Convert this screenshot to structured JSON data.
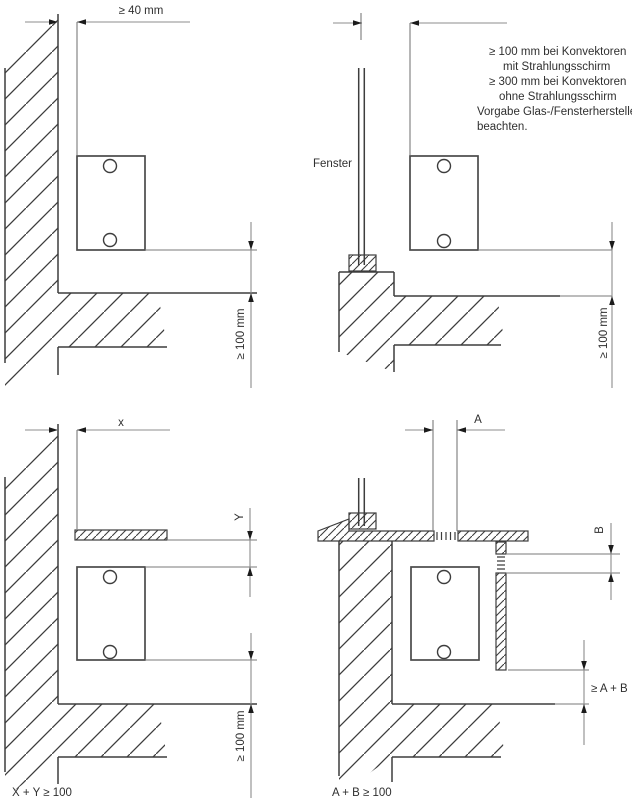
{
  "diagram": {
    "panels": {
      "top_left": {
        "dim_wall_gap": "≥ 40 mm",
        "dim_floor_clearance": "≥ 100 mm"
      },
      "top_right": {
        "window_label": "Fenster",
        "note_lines": [
          "≥ 100 mm bei Konvektoren",
          "mit Strahlungsschirm",
          "≥ 300 mm bei Konvektoren",
          "ohne Strahlungsschirm",
          "Vorgabe Glas-/Fensterhersteller",
          "beachten."
        ],
        "dim_floor_clearance": "≥ 100 mm"
      },
      "bottom_left": {
        "dim_wall_gap": "x",
        "dim_shelf_gap": "Y",
        "dim_floor_clearance": "≥ 100 mm",
        "formula": "X + Y ≥ 100"
      },
      "bottom_right": {
        "dim_grille_width": "A",
        "dim_grille_height": "B",
        "dim_floor_clearance": "≥ A + B",
        "formula": "A + B ≥ 100"
      }
    },
    "colors": {
      "background": "#ffffff",
      "drawing_line": "#3d3d3d",
      "dimension_line": "#8c8c8c",
      "arrow": "#1b1b1b",
      "text": "#2f2f2f"
    }
  }
}
